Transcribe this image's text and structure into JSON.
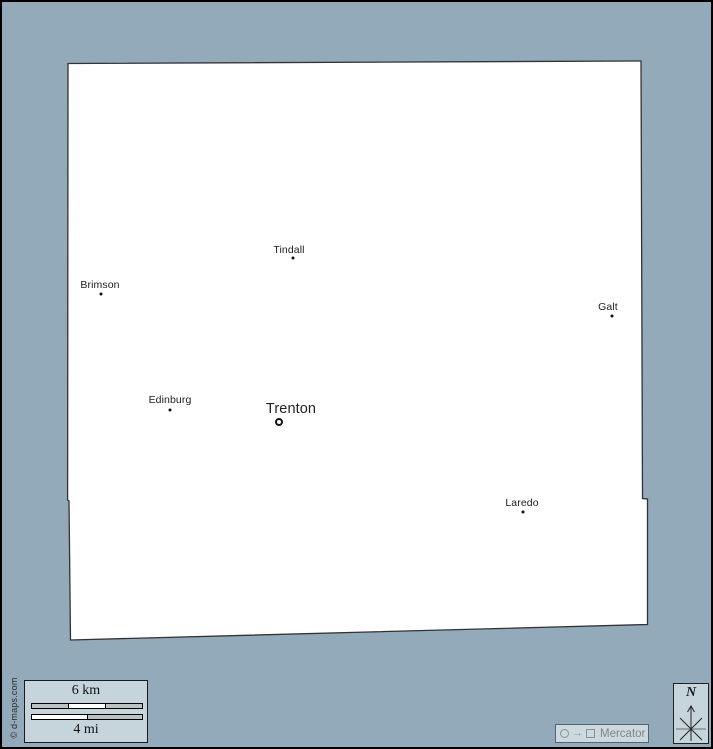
{
  "page": {
    "background_color": "#93aabb",
    "panel_color": "#c6d4dc"
  },
  "map": {
    "region_fill": "#ffffff",
    "outline_color": "#333333",
    "towns": [
      {
        "name": "Tindall",
        "marker": "dot"
      },
      {
        "name": "Brimson",
        "marker": "dot"
      },
      {
        "name": "Galt",
        "marker": "dot"
      },
      {
        "name": "Edinburg",
        "marker": "dot"
      },
      {
        "name": "Trenton",
        "marker": "ring"
      },
      {
        "name": "Laredo",
        "marker": "dot"
      }
    ]
  },
  "scale_bar": {
    "km_label": "6 km",
    "mi_label": "4 mi"
  },
  "projection": {
    "label": "Mercator",
    "arrow_glyph": "→"
  },
  "compass": {
    "north_label": "N"
  },
  "copyright_text": "© d-maps.com"
}
